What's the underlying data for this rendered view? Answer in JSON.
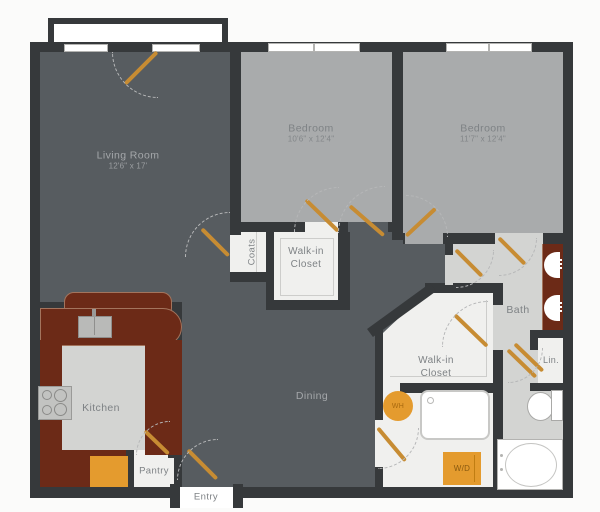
{
  "floorplan": {
    "rooms": {
      "living_room": {
        "name": "Living Room",
        "dims": "12'6\" x 17'"
      },
      "bedroom_1": {
        "name": "Bedroom",
        "dims": "10'6\" x 12'4\""
      },
      "bedroom_2": {
        "name": "Bedroom",
        "dims": "11'7\" x 12'4\""
      },
      "dining": {
        "name": "Dining"
      },
      "kitchen": {
        "name": "Kitchen"
      },
      "bath": {
        "name": "Bath"
      },
      "coats_closet": {
        "name": "Coats"
      },
      "walk_in_closet_1": {
        "line1": "Walk-in",
        "line2": "Closet"
      },
      "walk_in_closet_2": {
        "line1": "Walk-in",
        "line2": "Closet"
      },
      "linen_closet": {
        "name": "Lin."
      },
      "pantry": {
        "name": "Pantry"
      },
      "entry": {
        "name": "Entry"
      }
    },
    "fixtures": {
      "water_heater_label": "WH",
      "washer_dryer_label": "W/D"
    },
    "colors": {
      "bg": "#fbfbfa",
      "wall": "#36393b",
      "dark": "#575c60",
      "bed": "#a9abac",
      "light": "#d3d4d2",
      "closet": "#f0f0ee",
      "brown": "#6c2a17",
      "brownline": "#a3745d",
      "orange": "#e49b2e",
      "door": "#c78c33",
      "arc": "#b6b7b8",
      "txtdark": "#7e8285",
      "txtlight": "#a4a7aa",
      "winborder": "#b3b3b1"
    }
  }
}
